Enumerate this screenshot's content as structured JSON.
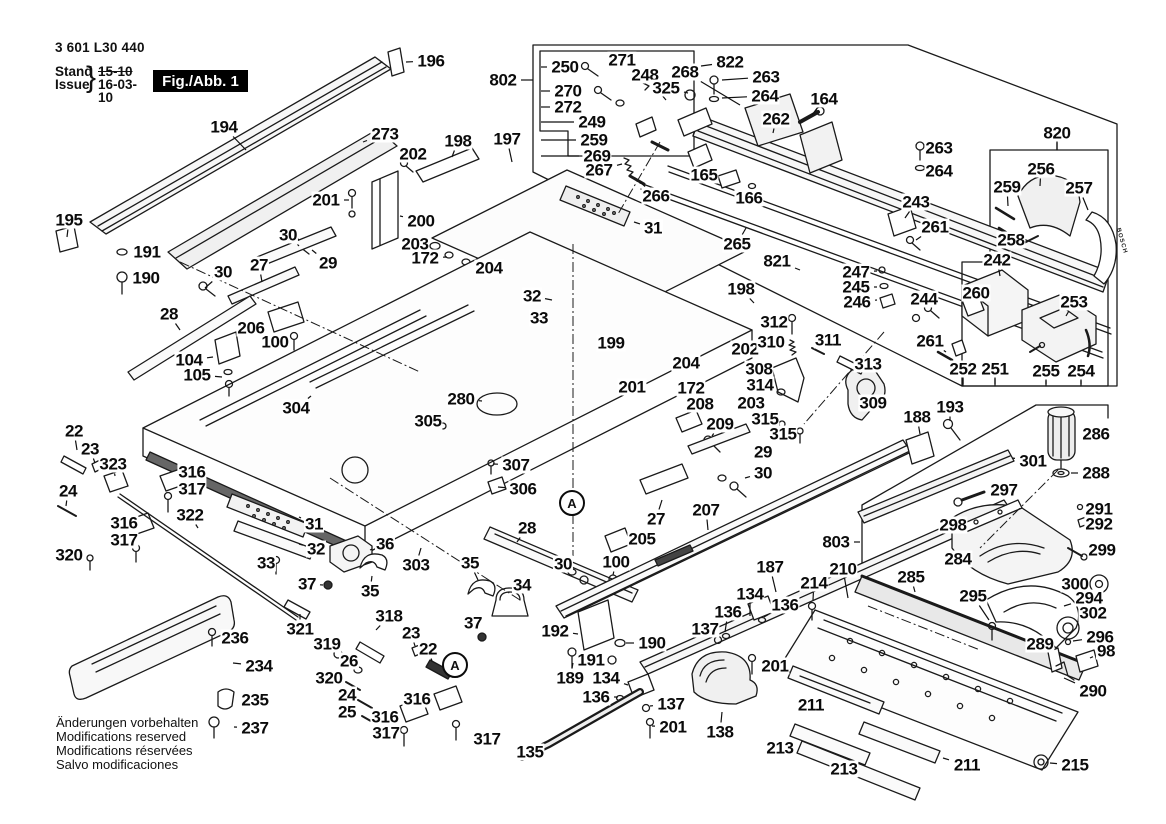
{
  "doc": {
    "part_number": "3 601 L30 440",
    "stand_label": "Stand",
    "issue_label": "Issue",
    "brace": "}",
    "stand_value": "15-10",
    "issue_value": "16-03-10",
    "figure_label": "Fig./Abb. 1"
  },
  "notes": [
    "Änderungen vorbehalten",
    "Modifications reserved",
    "Modifications réservées",
    "Salvo modificaciones"
  ],
  "branding": {
    "bosch_tag": "BOSCH"
  },
  "colors": {
    "line": "#1a1a1a",
    "label": "#0b0b0b",
    "fill_light": "#f6f6f6",
    "fill_dark": "#555555"
  },
  "callout_circles": [
    {
      "text": "A",
      "x": 572,
      "y": 503
    },
    {
      "text": "A",
      "x": 455,
      "y": 665
    }
  ],
  "labels": [
    {
      "t": "194",
      "x": 224,
      "y": 127,
      "lx": 246,
      "ly": 150
    },
    {
      "t": "273",
      "x": 385,
      "y": 134,
      "lx": 363,
      "ly": 142
    },
    {
      "t": "195",
      "x": 69,
      "y": 220,
      "lx": 67,
      "ly": 237
    },
    {
      "t": "191",
      "x": 147,
      "y": 252,
      "lx": 128,
      "ly": 252
    },
    {
      "t": "190",
      "x": 146,
      "y": 278,
      "lx": 127,
      "ly": 278
    },
    {
      "t": "201",
      "x": 326,
      "y": 200,
      "lx": 349,
      "ly": 200
    },
    {
      "t": "30",
      "x": 288,
      "y": 235,
      "lx": 299,
      "ly": 246
    },
    {
      "t": "29",
      "x": 328,
      "y": 263,
      "lx": 312,
      "ly": 250
    },
    {
      "t": "27",
      "x": 259,
      "y": 265,
      "lx": 262,
      "ly": 282
    },
    {
      "t": "30",
      "x": 223,
      "y": 272,
      "lx": 205,
      "ly": 288
    },
    {
      "t": "196",
      "x": 431,
      "y": 61,
      "lx": 406,
      "ly": 62
    },
    {
      "t": "802",
      "x": 503,
      "y": 80,
      "lx": 533,
      "ly": 80
    },
    {
      "t": "250",
      "x": 565,
      "y": 67,
      "lx": 541,
      "ly": 67
    },
    {
      "t": "271",
      "x": 622,
      "y": 60,
      "lx": 643,
      "ly": 72
    },
    {
      "t": "248",
      "x": 645,
      "y": 75,
      "lx": 666,
      "ly": 100
    },
    {
      "t": "268",
      "x": 685,
      "y": 72,
      "lx": 740,
      "ly": 105
    },
    {
      "t": "325",
      "x": 666,
      "y": 88,
      "lx": 688,
      "ly": 93
    },
    {
      "t": "270",
      "x": 568,
      "y": 91,
      "lx": 541,
      "ly": 91
    },
    {
      "t": "272",
      "x": 568,
      "y": 107,
      "lx": 541,
      "ly": 107
    },
    {
      "t": "249",
      "x": 592,
      "y": 122,
      "lx": 541,
      "ly": 122
    },
    {
      "t": "259",
      "x": 594,
      "y": 140,
      "lx": 541,
      "ly": 140
    },
    {
      "t": "269",
      "x": 597,
      "y": 156,
      "lx": 541,
      "ly": 156
    },
    {
      "t": "267",
      "x": 599,
      "y": 170,
      "lx": 622,
      "ly": 164
    },
    {
      "t": "266",
      "x": 656,
      "y": 196,
      "lx": 640,
      "ly": 182
    },
    {
      "t": "822",
      "x": 730,
      "y": 62,
      "lx": 701,
      "ly": 66
    },
    {
      "t": "263",
      "x": 766,
      "y": 77,
      "lx": 722,
      "ly": 80
    },
    {
      "t": "264",
      "x": 765,
      "y": 96,
      "lx": 722,
      "ly": 98
    },
    {
      "t": "262",
      "x": 776,
      "y": 119,
      "lx": 773,
      "ly": 133
    },
    {
      "t": "164",
      "x": 824,
      "y": 99,
      "lx": 812,
      "ly": 115
    },
    {
      "t": "165",
      "x": 704,
      "y": 175,
      "lx": 720,
      "ly": 179
    },
    {
      "t": "166",
      "x": 749,
      "y": 198,
      "lx": 752,
      "ly": 189
    },
    {
      "t": "265",
      "x": 737,
      "y": 244,
      "lx": 746,
      "ly": 228
    },
    {
      "t": "821",
      "x": 777,
      "y": 261,
      "lx": 800,
      "ly": 270
    },
    {
      "t": "263",
      "x": 939,
      "y": 148,
      "lx": 925,
      "ly": 149
    },
    {
      "t": "264",
      "x": 939,
      "y": 171,
      "lx": 925,
      "ly": 170
    },
    {
      "t": "243",
      "x": 916,
      "y": 202,
      "lx": 905,
      "ly": 218
    },
    {
      "t": "261",
      "x": 935,
      "y": 227,
      "lx": 916,
      "ly": 240
    },
    {
      "t": "820",
      "x": 1057,
      "y": 133,
      "lx": 1057,
      "ly": 150
    },
    {
      "t": "256",
      "x": 1041,
      "y": 169,
      "lx": 1040,
      "ly": 186
    },
    {
      "t": "259",
      "x": 1007,
      "y": 187,
      "lx": 1008,
      "ly": 206
    },
    {
      "t": "257",
      "x": 1079,
      "y": 188,
      "lx": 1088,
      "ly": 210
    },
    {
      "t": "258",
      "x": 1011,
      "y": 240,
      "lx": 1026,
      "ly": 242
    },
    {
      "t": "242",
      "x": 997,
      "y": 260,
      "lx": 1000,
      "ly": 276
    },
    {
      "t": "247",
      "x": 856,
      "y": 272,
      "lx": 877,
      "ly": 271
    },
    {
      "t": "245",
      "x": 856,
      "y": 287,
      "lx": 877,
      "ly": 287
    },
    {
      "t": "246",
      "x": 857,
      "y": 302,
      "lx": 877,
      "ly": 300
    },
    {
      "t": "244",
      "x": 924,
      "y": 299,
      "lx": 926,
      "ly": 306
    },
    {
      "t": "260",
      "x": 976,
      "y": 293,
      "lx": 971,
      "ly": 300
    },
    {
      "t": "253",
      "x": 1074,
      "y": 302,
      "lx": 1066,
      "ly": 316
    },
    {
      "t": "261",
      "x": 930,
      "y": 341,
      "lx": 946,
      "ly": 352
    },
    {
      "t": "252",
      "x": 963,
      "y": 369,
      "lx": 963,
      "ly": 384
    },
    {
      "t": "251",
      "x": 995,
      "y": 369,
      "lx": 995,
      "ly": 384
    },
    {
      "t": "255",
      "x": 1046,
      "y": 371,
      "lx": 1046,
      "ly": 384
    },
    {
      "t": "254",
      "x": 1081,
      "y": 371,
      "lx": 1081,
      "ly": 384
    },
    {
      "t": "198",
      "x": 458,
      "y": 141,
      "lx": 452,
      "ly": 157
    },
    {
      "t": "197",
      "x": 507,
      "y": 139,
      "lx": 512,
      "ly": 162
    },
    {
      "t": "202",
      "x": 413,
      "y": 154,
      "lx": 406,
      "ly": 163
    },
    {
      "t": "200",
      "x": 421,
      "y": 221,
      "lx": 400,
      "ly": 216
    },
    {
      "t": "203",
      "x": 415,
      "y": 244,
      "lx": 433,
      "ly": 246
    },
    {
      "t": "172",
      "x": 425,
      "y": 258,
      "lx": 447,
      "ly": 257
    },
    {
      "t": "204",
      "x": 489,
      "y": 268,
      "lx": 470,
      "ly": 263
    },
    {
      "t": "31",
      "x": 653,
      "y": 228,
      "lx": 634,
      "ly": 222
    },
    {
      "t": "198",
      "x": 741,
      "y": 289,
      "lx": 754,
      "ly": 303
    },
    {
      "t": "32",
      "x": 532,
      "y": 296,
      "lx": 552,
      "ly": 300
    },
    {
      "t": "33",
      "x": 539,
      "y": 318,
      "lx": 554,
      "ly": 318
    },
    {
      "t": "28",
      "x": 169,
      "y": 314,
      "lx": 180,
      "ly": 330
    },
    {
      "t": "206",
      "x": 251,
      "y": 328,
      "lx": 268,
      "ly": 324
    },
    {
      "t": "100",
      "x": 275,
      "y": 342,
      "lx": 291,
      "ly": 341
    },
    {
      "t": "104",
      "x": 189,
      "y": 360,
      "lx": 213,
      "ly": 357
    },
    {
      "t": "105",
      "x": 197,
      "y": 375,
      "lx": 222,
      "ly": 377
    },
    {
      "t": "304",
      "x": 296,
      "y": 408,
      "lx": 311,
      "ly": 396
    },
    {
      "t": "280",
      "x": 461,
      "y": 399,
      "lx": 482,
      "ly": 401
    },
    {
      "t": "305",
      "x": 428,
      "y": 421,
      "lx": 443,
      "ly": 423
    },
    {
      "t": "307",
      "x": 516,
      "y": 465,
      "lx": 493,
      "ly": 464
    },
    {
      "t": "306",
      "x": 523,
      "y": 489,
      "lx": 498,
      "ly": 487
    },
    {
      "t": "199",
      "x": 611,
      "y": 343,
      "lx": 628,
      "ly": 351
    },
    {
      "t": "202",
      "x": 745,
      "y": 349,
      "lx": 730,
      "ly": 354
    },
    {
      "t": "204",
      "x": 686,
      "y": 363,
      "lx": 677,
      "ly": 370
    },
    {
      "t": "201",
      "x": 632,
      "y": 387,
      "lx": 647,
      "ly": 388
    },
    {
      "t": "172",
      "x": 691,
      "y": 388,
      "lx": 701,
      "ly": 390
    },
    {
      "t": "203",
      "x": 751,
      "y": 403,
      "lx": 736,
      "ly": 400
    },
    {
      "t": "208",
      "x": 700,
      "y": 404,
      "lx": 691,
      "ly": 414
    },
    {
      "t": "209",
      "x": 720,
      "y": 424,
      "lx": 712,
      "ly": 436
    },
    {
      "t": "312",
      "x": 774,
      "y": 322,
      "lx": 789,
      "ly": 322
    },
    {
      "t": "310",
      "x": 771,
      "y": 342,
      "lx": 787,
      "ly": 343
    },
    {
      "t": "311",
      "x": 828,
      "y": 340,
      "lx": 819,
      "ly": 349
    },
    {
      "t": "313",
      "x": 868,
      "y": 364,
      "lx": 853,
      "ly": 366
    },
    {
      "t": "308",
      "x": 759,
      "y": 369,
      "lx": 774,
      "ly": 370
    },
    {
      "t": "314",
      "x": 760,
      "y": 385,
      "lx": 776,
      "ly": 388
    },
    {
      "t": "309",
      "x": 873,
      "y": 403,
      "lx": 858,
      "ly": 402
    },
    {
      "t": "315",
      "x": 765,
      "y": 419,
      "lx": 780,
      "ly": 422
    },
    {
      "t": "315",
      "x": 783,
      "y": 434,
      "lx": 798,
      "ly": 432
    },
    {
      "t": "29",
      "x": 763,
      "y": 452,
      "lx": 748,
      "ly": 452
    },
    {
      "t": "30",
      "x": 763,
      "y": 473,
      "lx": 745,
      "ly": 478
    },
    {
      "t": "27",
      "x": 656,
      "y": 519,
      "lx": 662,
      "ly": 500
    },
    {
      "t": "207",
      "x": 706,
      "y": 510,
      "lx": 708,
      "ly": 530
    },
    {
      "t": "187",
      "x": 770,
      "y": 567,
      "lx": 776,
      "ly": 592
    },
    {
      "t": "28",
      "x": 527,
      "y": 528,
      "lx": 517,
      "ly": 542
    },
    {
      "t": "205",
      "x": 642,
      "y": 539,
      "lx": 624,
      "ly": 543
    },
    {
      "t": "100",
      "x": 616,
      "y": 562,
      "lx": 613,
      "ly": 575
    },
    {
      "t": "30",
      "x": 563,
      "y": 564,
      "lx": 572,
      "ly": 571
    },
    {
      "t": "22",
      "x": 74,
      "y": 431,
      "lx": 77,
      "ly": 450
    },
    {
      "t": "23",
      "x": 90,
      "y": 449,
      "lx": 95,
      "ly": 463
    },
    {
      "t": "323",
      "x": 113,
      "y": 464,
      "lx": 115,
      "ly": 476
    },
    {
      "t": "24",
      "x": 68,
      "y": 491,
      "lx": 66,
      "ly": 506
    },
    {
      "t": "316",
      "x": 192,
      "y": 472,
      "lx": 177,
      "ly": 478
    },
    {
      "t": "317",
      "x": 192,
      "y": 489,
      "lx": 176,
      "ly": 494
    },
    {
      "t": "316",
      "x": 124,
      "y": 523,
      "lx": 135,
      "ly": 522
    },
    {
      "t": "317",
      "x": 124,
      "y": 540,
      "lx": 134,
      "ly": 545
    },
    {
      "t": "320",
      "x": 69,
      "y": 555,
      "lx": 86,
      "ly": 558
    },
    {
      "t": "322",
      "x": 190,
      "y": 515,
      "lx": 198,
      "ly": 528
    },
    {
      "t": "31",
      "x": 314,
      "y": 524,
      "lx": 299,
      "ly": 517
    },
    {
      "t": "32",
      "x": 316,
      "y": 549,
      "lx": 299,
      "ly": 544
    },
    {
      "t": "33",
      "x": 266,
      "y": 563,
      "lx": 275,
      "ly": 560
    },
    {
      "t": "36",
      "x": 385,
      "y": 544,
      "lx": 370,
      "ly": 550
    },
    {
      "t": "35",
      "x": 470,
      "y": 563,
      "lx": 478,
      "ly": 580
    },
    {
      "t": "303",
      "x": 416,
      "y": 565,
      "lx": 421,
      "ly": 548
    },
    {
      "t": "35",
      "x": 370,
      "y": 591,
      "lx": 372,
      "ly": 576
    },
    {
      "t": "37",
      "x": 307,
      "y": 584,
      "lx": 323,
      "ly": 585
    },
    {
      "t": "34",
      "x": 522,
      "y": 585,
      "lx": 514,
      "ly": 596
    },
    {
      "t": "37",
      "x": 473,
      "y": 623,
      "lx": 480,
      "ly": 634
    },
    {
      "t": "318",
      "x": 389,
      "y": 616,
      "lx": 376,
      "ly": 630
    },
    {
      "t": "321",
      "x": 300,
      "y": 629,
      "lx": 300,
      "ly": 614
    },
    {
      "t": "319",
      "x": 327,
      "y": 644,
      "lx": 335,
      "ly": 652
    },
    {
      "t": "26",
      "x": 349,
      "y": 661,
      "lx": 356,
      "ly": 668
    },
    {
      "t": "320",
      "x": 329,
      "y": 678,
      "lx": 344,
      "ly": 682
    },
    {
      "t": "24",
      "x": 347,
      "y": 695,
      "lx": 358,
      "ly": 700
    },
    {
      "t": "25",
      "x": 347,
      "y": 712,
      "lx": 361,
      "ly": 716
    },
    {
      "t": "23",
      "x": 411,
      "y": 633,
      "lx": 415,
      "ly": 646
    },
    {
      "t": "22",
      "x": 428,
      "y": 649,
      "lx": 432,
      "ly": 661
    },
    {
      "t": "316",
      "x": 417,
      "y": 699,
      "lx": 434,
      "ly": 698
    },
    {
      "t": "316",
      "x": 385,
      "y": 717,
      "lx": 401,
      "ly": 712
    },
    {
      "t": "317",
      "x": 386,
      "y": 733,
      "lx": 399,
      "ly": 731
    },
    {
      "t": "317",
      "x": 487,
      "y": 739,
      "lx": 468,
      "ly": 735
    },
    {
      "t": "236",
      "x": 235,
      "y": 638,
      "lx": 219,
      "ly": 637
    },
    {
      "t": "234",
      "x": 259,
      "y": 666,
      "lx": 233,
      "ly": 663
    },
    {
      "t": "235",
      "x": 255,
      "y": 700,
      "lx": 236,
      "ly": 700
    },
    {
      "t": "237",
      "x": 255,
      "y": 728,
      "lx": 234,
      "ly": 727
    },
    {
      "t": "192",
      "x": 555,
      "y": 631,
      "lx": 578,
      "ly": 634
    },
    {
      "t": "190",
      "x": 652,
      "y": 643,
      "lx": 626,
      "ly": 643
    },
    {
      "t": "191",
      "x": 591,
      "y": 660,
      "lx": 609,
      "ly": 658
    },
    {
      "t": "189",
      "x": 570,
      "y": 678,
      "lx": 573,
      "ly": 663
    },
    {
      "t": "134",
      "x": 750,
      "y": 594,
      "lx": 750,
      "ly": 616
    },
    {
      "t": "136",
      "x": 728,
      "y": 612,
      "lx": 725,
      "ly": 632
    },
    {
      "t": "136",
      "x": 785,
      "y": 605,
      "lx": 764,
      "ly": 617
    },
    {
      "t": "137",
      "x": 705,
      "y": 629,
      "lx": 720,
      "ly": 637
    },
    {
      "t": "134",
      "x": 606,
      "y": 678,
      "lx": 628,
      "ly": 685
    },
    {
      "t": "136",
      "x": 596,
      "y": 697,
      "lx": 618,
      "ly": 697
    },
    {
      "t": "137",
      "x": 671,
      "y": 704,
      "lx": 650,
      "ly": 706
    },
    {
      "t": "201",
      "x": 673,
      "y": 727,
      "lx": 652,
      "ly": 726
    },
    {
      "t": "201",
      "x": 775,
      "y": 666,
      "lx": 757,
      "ly": 665
    },
    {
      "t": "138",
      "x": 720,
      "y": 732,
      "lx": 722,
      "ly": 712
    },
    {
      "t": "135",
      "x": 530,
      "y": 752,
      "lx": 547,
      "ly": 748
    },
    {
      "t": "213",
      "x": 780,
      "y": 748,
      "lx": 794,
      "ly": 740
    },
    {
      "t": "213",
      "x": 844,
      "y": 769,
      "lx": 858,
      "ly": 760
    },
    {
      "t": "211",
      "x": 811,
      "y": 705,
      "lx": 826,
      "ly": 712
    },
    {
      "t": "211",
      "x": 967,
      "y": 765,
      "lx": 943,
      "ly": 758
    },
    {
      "t": "215",
      "x": 1075,
      "y": 765,
      "lx": 1050,
      "ly": 763
    },
    {
      "t": "214",
      "x": 814,
      "y": 583,
      "lx": 813,
      "ly": 600
    },
    {
      "t": "210",
      "x": 843,
      "y": 569,
      "lx": 848,
      "ly": 598
    },
    {
      "t": "285",
      "x": 911,
      "y": 577,
      "lx": 915,
      "ly": 592
    },
    {
      "t": "295",
      "x": 973,
      "y": 596,
      "lx": 989,
      "ly": 620
    },
    {
      "t": "284",
      "x": 958,
      "y": 559,
      "lx": 976,
      "ly": 552
    },
    {
      "t": "300",
      "x": 1075,
      "y": 584,
      "lx": 1089,
      "ly": 584
    },
    {
      "t": "294",
      "x": 1089,
      "y": 598,
      "lx": 1064,
      "ly": 606
    },
    {
      "t": "302",
      "x": 1093,
      "y": 613,
      "lx": 1077,
      "ly": 621
    },
    {
      "t": "296",
      "x": 1100,
      "y": 637,
      "lx": 1073,
      "ly": 641
    },
    {
      "t": "98",
      "x": 1106,
      "y": 651,
      "lx": 1090,
      "ly": 658
    },
    {
      "t": "289",
      "x": 1040,
      "y": 644,
      "lx": 1050,
      "ly": 654
    },
    {
      "t": "290",
      "x": 1093,
      "y": 691,
      "lx": 1064,
      "ly": 678
    },
    {
      "t": "286",
      "x": 1096,
      "y": 434,
      "lx": 1077,
      "ly": 434
    },
    {
      "t": "301",
      "x": 1033,
      "y": 461,
      "lx": 1012,
      "ly": 458
    },
    {
      "t": "288",
      "x": 1096,
      "y": 473,
      "lx": 1071,
      "ly": 473
    },
    {
      "t": "297",
      "x": 1004,
      "y": 490,
      "lx": 986,
      "ly": 496
    },
    {
      "t": "298",
      "x": 953,
      "y": 525,
      "lx": 967,
      "ly": 520
    },
    {
      "t": "291",
      "x": 1099,
      "y": 509,
      "lx": 1084,
      "ly": 508
    },
    {
      "t": "292",
      "x": 1099,
      "y": 524,
      "lx": 1085,
      "ly": 523
    },
    {
      "t": "299",
      "x": 1102,
      "y": 550,
      "lx": 1087,
      "ly": 553
    },
    {
      "t": "188",
      "x": 917,
      "y": 417,
      "lx": 920,
      "ly": 434
    },
    {
      "t": "193",
      "x": 950,
      "y": 407,
      "lx": 950,
      "ly": 421
    },
    {
      "t": "803",
      "x": 836,
      "y": 542,
      "lx": 860,
      "ly": 542
    },
    {
      "t": "309",
      "x": 873,
      "y": 403,
      "lx": 860,
      "ly": 398
    }
  ]
}
